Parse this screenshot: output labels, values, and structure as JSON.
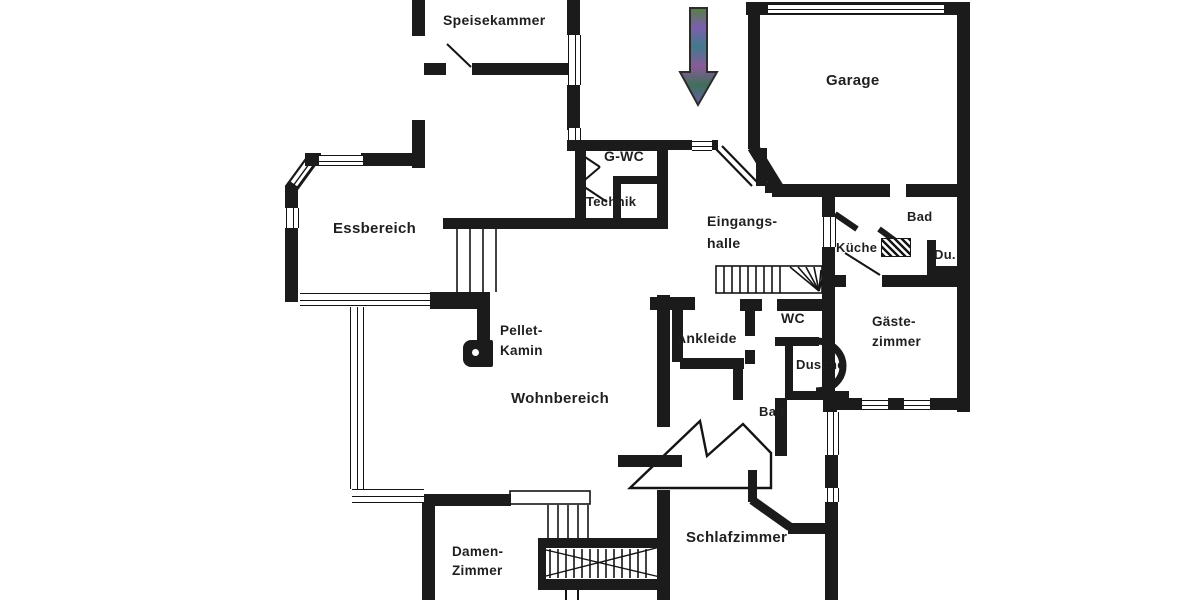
{
  "floorplan": {
    "type": "architectural-floor-plan",
    "background_color": "#ffffff",
    "wall_color": "#1b1b1b",
    "label_color": "#1f1f1f",
    "rooms": [
      {
        "label": "Speisekammer"
      },
      {
        "label": "Garage"
      },
      {
        "label": "G-WC"
      },
      {
        "label": "Technik"
      },
      {
        "label": "Essbereich"
      },
      {
        "label": "Eingangs-",
        "label2": "halle"
      },
      {
        "label": "Bad"
      },
      {
        "label": "Küche"
      },
      {
        "label": "Du."
      },
      {
        "label": "Gäste-",
        "label2": "zimmer"
      },
      {
        "label": "WC"
      },
      {
        "label": "Ankleide"
      },
      {
        "label": "Dusche"
      },
      {
        "label": "Pellet-",
        "label2": "Kamin"
      },
      {
        "label": "Wohnbereich"
      },
      {
        "label": "Bad"
      },
      {
        "label": "Schlafzimmer"
      },
      {
        "label": "Damen-",
        "label2": "Zimmer"
      }
    ],
    "entrance_arrow": {
      "direction": "down",
      "colors": [
        "#55803f",
        "#7d5fae",
        "#417a8c",
        "#8a5a9b",
        "#3f6f5a",
        "#6c5fae"
      ]
    },
    "features": [
      "main-staircase",
      "entry-winder-staircase",
      "d-shape-shower",
      "pellet-stove",
      "bay-window",
      "garage-door"
    ]
  }
}
